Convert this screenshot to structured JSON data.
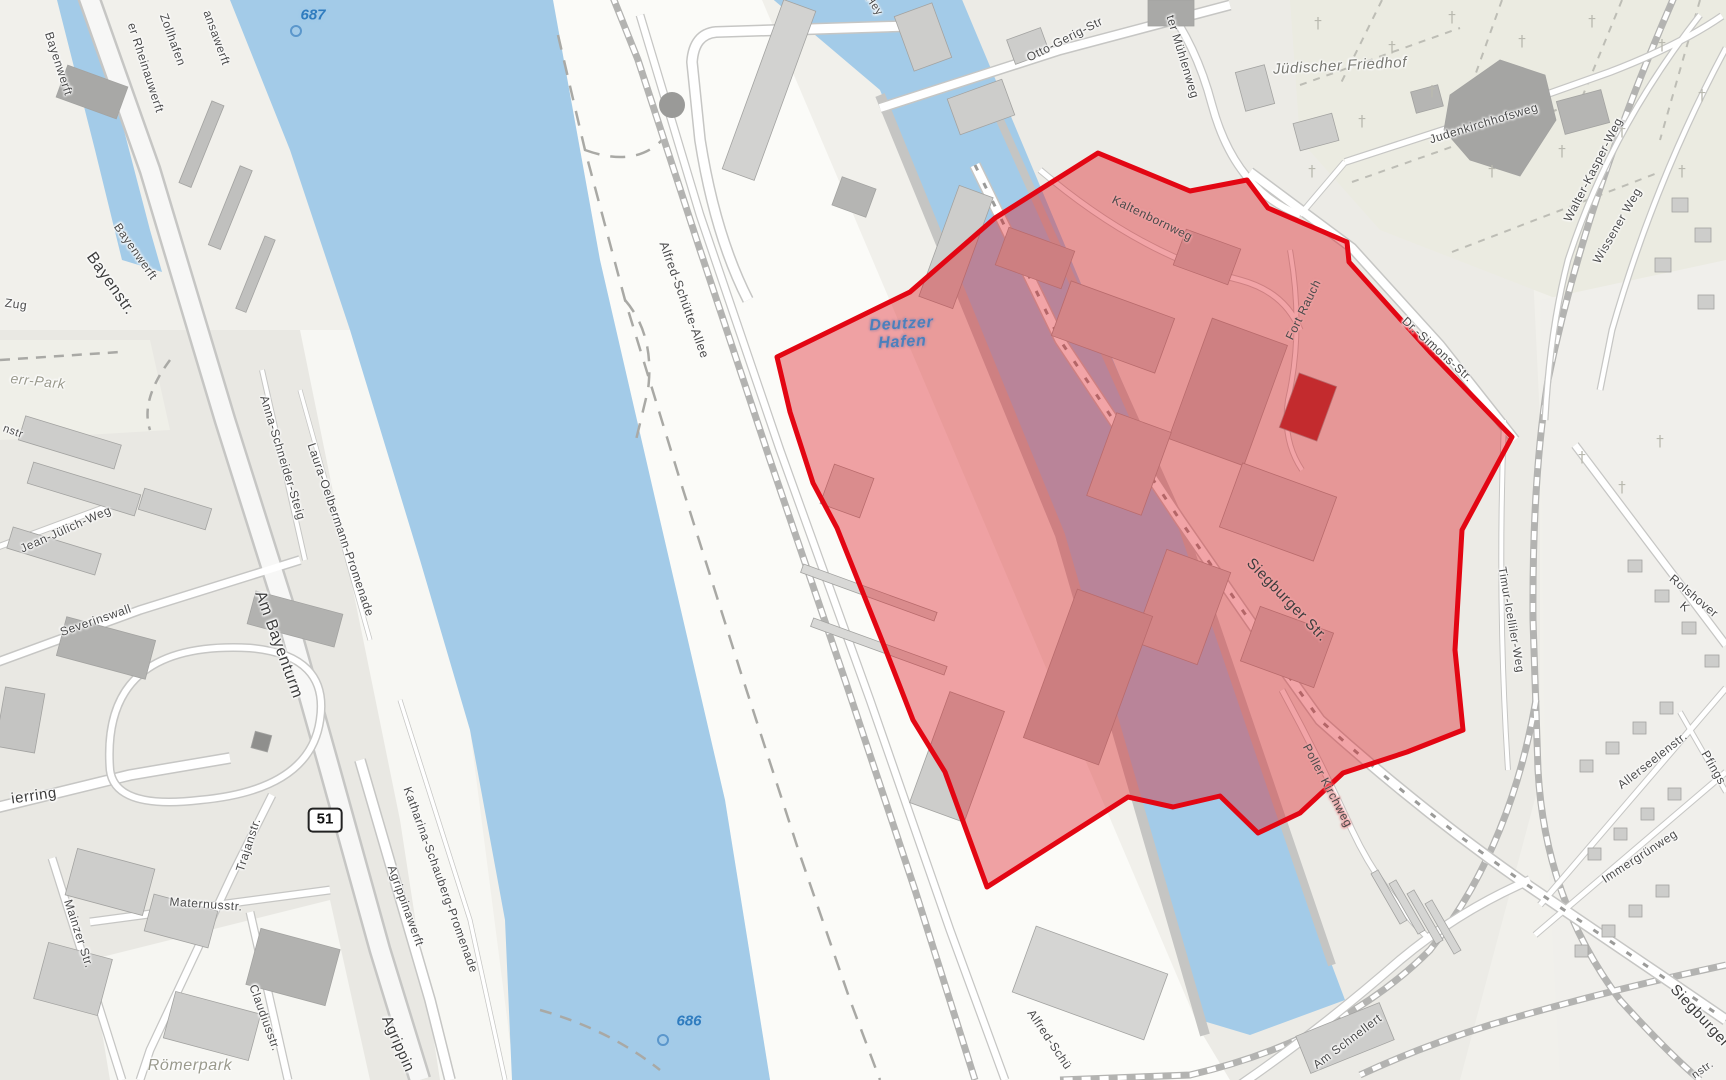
{
  "map": {
    "kind": "street-map with highlighted district",
    "depicted_area": "Deutzer Hafen / Köln Südstadt",
    "colors": {
      "water": "#a3cbe8",
      "land": "#f1f0eb",
      "highlight_fill": "rgba(222,16,24,0.38)",
      "highlight_stroke": "#e30613"
    }
  },
  "highlight": {
    "name": "selected-district-polygon",
    "stroke_width": 5,
    "points": [
      [
        777,
        357
      ],
      [
        910,
        292
      ],
      [
        995,
        218
      ],
      [
        1098,
        153
      ],
      [
        1190,
        191
      ],
      [
        1247,
        180
      ],
      [
        1268,
        208
      ],
      [
        1347,
        242
      ],
      [
        1349,
        262
      ],
      [
        1430,
        352
      ],
      [
        1512,
        437
      ],
      [
        1462,
        530
      ],
      [
        1455,
        650
      ],
      [
        1463,
        730
      ],
      [
        1407,
        752
      ],
      [
        1343,
        773
      ],
      [
        1300,
        813
      ],
      [
        1258,
        833
      ],
      [
        1220,
        796
      ],
      [
        1173,
        807
      ],
      [
        1128,
        797
      ],
      [
        987,
        887
      ],
      [
        945,
        772
      ],
      [
        913,
        720
      ],
      [
        883,
        643
      ],
      [
        837,
        528
      ],
      [
        813,
        483
      ],
      [
        790,
        412
      ]
    ]
  },
  "markers": {
    "route_badge": {
      "text": "51",
      "x": 325,
      "y": 820
    },
    "river_km": [
      {
        "text": "687",
        "x": 313,
        "y": 15,
        "cx": 296,
        "cy": 31
      },
      {
        "text": "686",
        "x": 689,
        "y": 1021,
        "cx": 663,
        "cy": 1040
      }
    ]
  },
  "labels": [
    {
      "id": "bayenwerft-north",
      "text": "Bayenwerft",
      "x": 58,
      "y": 64,
      "rot": 72,
      "kind": "street",
      "size": 12,
      "halo": "white"
    },
    {
      "id": "er-rheinauwerft",
      "text": "er Rheinauwerft",
      "x": 145,
      "y": 68,
      "rot": 72,
      "kind": "street",
      "size": 12,
      "halo": "white"
    },
    {
      "id": "zollhafen",
      "text": "Zollhafen",
      "x": 172,
      "y": 40,
      "rot": 70,
      "kind": "street",
      "size": 12,
      "halo": "white"
    },
    {
      "id": "ansawerft",
      "text": "ansawerft",
      "x": 216,
      "y": 38,
      "rot": 70,
      "kind": "street",
      "size": 12,
      "halo": "white"
    },
    {
      "id": "bayenstr",
      "text": "Bayenstr.",
      "x": 110,
      "y": 284,
      "rot": 55,
      "kind": "major",
      "size": 16,
      "halo": "white"
    },
    {
      "id": "bayenwerft-south",
      "text": "Bayenwerft",
      "x": 135,
      "y": 252,
      "rot": 55,
      "kind": "street",
      "size": 12,
      "halo": "white"
    },
    {
      "id": "zug",
      "text": "Zug",
      "x": 16,
      "y": 305,
      "rot": 8,
      "kind": "street",
      "size": 12,
      "halo": "white"
    },
    {
      "id": "err-park",
      "text": "err-Park",
      "x": 38,
      "y": 381,
      "rot": 6,
      "kind": "park",
      "size": 14,
      "halo": "white"
    },
    {
      "id": "nstr",
      "text": "nstr",
      "x": 13,
      "y": 432,
      "rot": 20,
      "kind": "street",
      "size": 11,
      "halo": "white"
    },
    {
      "id": "jean-juelich-weg",
      "text": "Jean-Jülich-Weg",
      "x": 66,
      "y": 530,
      "rot": -24,
      "kind": "street",
      "size": 12,
      "halo": "white"
    },
    {
      "id": "severinswall",
      "text": "Severinswall",
      "x": 96,
      "y": 621,
      "rot": -19,
      "kind": "street",
      "size": 12,
      "halo": "white"
    },
    {
      "id": "anna-schneider-steig",
      "text": "Anna-Schneider-Steig",
      "x": 282,
      "y": 458,
      "rot": 73,
      "kind": "street",
      "size": 12,
      "halo": "white"
    },
    {
      "id": "laura-oelbermann-promenade",
      "text": "Laura-Oelbermann-Promenade",
      "x": 340,
      "y": 530,
      "rot": 71,
      "kind": "street",
      "size": 12,
      "halo": "white"
    },
    {
      "id": "am-bayenturm",
      "text": "Am Bayenturm",
      "x": 278,
      "y": 645,
      "rot": 70,
      "kind": "major",
      "size": 16,
      "halo": "white"
    },
    {
      "id": "ierring",
      "text": "ierring",
      "x": 34,
      "y": 796,
      "rot": -8,
      "kind": "major",
      "size": 15,
      "halo": "white"
    },
    {
      "id": "trajanstr",
      "text": "Trajanstr.",
      "x": 249,
      "y": 845,
      "rot": -72,
      "kind": "street",
      "size": 12,
      "halo": "white"
    },
    {
      "id": "maternusstr",
      "text": "Maternusstr.",
      "x": 206,
      "y": 905,
      "rot": 4,
      "kind": "street",
      "size": 12,
      "halo": "white"
    },
    {
      "id": "mainzer-str",
      "text": "Mainzer Str.",
      "x": 78,
      "y": 934,
      "rot": 72,
      "kind": "street",
      "size": 12,
      "halo": "white"
    },
    {
      "id": "claudiusstr",
      "text": "Claudiusstr.",
      "x": 264,
      "y": 1018,
      "rot": 70,
      "kind": "street",
      "size": 12,
      "halo": "white"
    },
    {
      "id": "roemerpark",
      "text": "Römerpark",
      "x": 190,
      "y": 1066,
      "rot": 0,
      "kind": "park",
      "size": 16,
      "halo": "white"
    },
    {
      "id": "agrippinawerft",
      "text": "Agrippinawerft",
      "x": 405,
      "y": 906,
      "rot": 70,
      "kind": "street",
      "size": 12,
      "halo": "white"
    },
    {
      "id": "katharina-schauberg-promenade",
      "text": "Katharina-Schauberg-Promenade",
      "x": 440,
      "y": 880,
      "rot": 70,
      "kind": "street",
      "size": 12,
      "halo": "white"
    },
    {
      "id": "agrippin",
      "text": "Agrippin",
      "x": 398,
      "y": 1044,
      "rot": 66,
      "kind": "major",
      "size": 15,
      "halo": "white"
    },
    {
      "id": "alfred-schuette-allee",
      "text": "Alfred-Schütte-Allee",
      "x": 684,
      "y": 300,
      "rot": 70,
      "kind": "street",
      "size": 12.5,
      "halo": "white"
    },
    {
      "id": "alfred-schue-south",
      "text": "Alfred-Schü",
      "x": 1049,
      "y": 1040,
      "rot": 56,
      "kind": "street",
      "size": 12,
      "halo": "white"
    },
    {
      "id": "am-schnellert",
      "text": "Am Schnellert",
      "x": 1348,
      "y": 1042,
      "rot": -37,
      "kind": "street",
      "size": 12,
      "halo": "white"
    },
    {
      "id": "immergruenweg",
      "text": "Immergrünweg",
      "x": 1640,
      "y": 857,
      "rot": -33,
      "kind": "street",
      "size": 12,
      "halo": "white"
    },
    {
      "id": "allerseelenstr",
      "text": "Allerseelenstr.",
      "x": 1653,
      "y": 761,
      "rot": -38,
      "kind": "street",
      "size": 12,
      "halo": "white"
    },
    {
      "id": "pfings",
      "text": "Pfings",
      "x": 1713,
      "y": 768,
      "rot": 60,
      "kind": "street",
      "size": 12,
      "halo": "white"
    },
    {
      "id": "rolshover-k",
      "text": "Rolshover K",
      "x": 1689,
      "y": 602,
      "rot": 40,
      "kind": "street",
      "size": 12,
      "halo": "white"
    },
    {
      "id": "timur-icelliler-weg",
      "text": "Timur-Icelliler-Weg",
      "x": 1510,
      "y": 620,
      "rot": 80,
      "kind": "street",
      "size": 11.5,
      "halo": "white"
    },
    {
      "id": "siegburger-str",
      "text": "Siegburger Str.",
      "x": 1287,
      "y": 600,
      "rot": 46,
      "kind": "major",
      "size": 15,
      "halo": "pink"
    },
    {
      "id": "siegburger-south",
      "text": "Siegburger",
      "x": 1700,
      "y": 1016,
      "rot": 47,
      "kind": "major",
      "size": 15,
      "halo": "white"
    },
    {
      "id": "nstr-corner",
      "text": "nstr.",
      "x": 1703,
      "y": 1070,
      "rot": -35,
      "kind": "street",
      "size": 11,
      "halo": "white"
    },
    {
      "id": "poller-kirchweg",
      "text": "Poller Kirchweg",
      "x": 1327,
      "y": 786,
      "rot": 62,
      "kind": "street",
      "size": 12,
      "halo": "pink"
    },
    {
      "id": "kaltenbornweg",
      "text": "Kaltenbornweg",
      "x": 1152,
      "y": 219,
      "rot": 26,
      "kind": "street",
      "size": 12,
      "halo": "pink"
    },
    {
      "id": "fort-rauch",
      "text": "Fort Rauch",
      "x": 1304,
      "y": 310,
      "rot": -64,
      "kind": "street",
      "size": 12,
      "halo": "pink"
    },
    {
      "id": "dr-simons-str",
      "text": "Dr.-Simons-Str.",
      "x": 1437,
      "y": 350,
      "rot": 42,
      "kind": "street",
      "size": 12,
      "halo": "white"
    },
    {
      "id": "deutzer-hafen",
      "text": "Deutzer\nHafen",
      "x": 902,
      "y": 334,
      "rot": -3,
      "kind": "water",
      "size": 16,
      "halo": "mauve"
    },
    {
      "id": "juedischer-friedhof",
      "text": "Jüdischer Friedhof",
      "x": 1340,
      "y": 66,
      "rot": -3,
      "kind": "cemetery",
      "size": 15,
      "halo": "white"
    },
    {
      "id": "judenkirchhofsweg",
      "text": "Judenkirchhofsweg",
      "x": 1484,
      "y": 124,
      "rot": -17,
      "kind": "street",
      "size": 12,
      "halo": "white"
    },
    {
      "id": "walter-kasper-weg",
      "text": "Walter-Kasper-Weg",
      "x": 1594,
      "y": 170,
      "rot": -63,
      "kind": "street",
      "size": 12,
      "halo": "white"
    },
    {
      "id": "wissener-weg",
      "text": "Wissener Weg",
      "x": 1618,
      "y": 226,
      "rot": -60,
      "kind": "street",
      "size": 12,
      "halo": "white"
    },
    {
      "id": "otto-gerig-str",
      "text": "Otto-Gerig-Str",
      "x": 1065,
      "y": 40,
      "rot": -27,
      "kind": "street",
      "size": 12,
      "halo": "white"
    },
    {
      "id": "ter-muehlenweg",
      "text": "ter Mühlenweg",
      "x": 1182,
      "y": 57,
      "rot": 73,
      "kind": "street",
      "size": 12,
      "halo": "white"
    },
    {
      "id": "hey",
      "text": "Hey",
      "x": 874,
      "y": 6,
      "rot": 55,
      "kind": "street",
      "size": 11,
      "halo": "white"
    }
  ]
}
